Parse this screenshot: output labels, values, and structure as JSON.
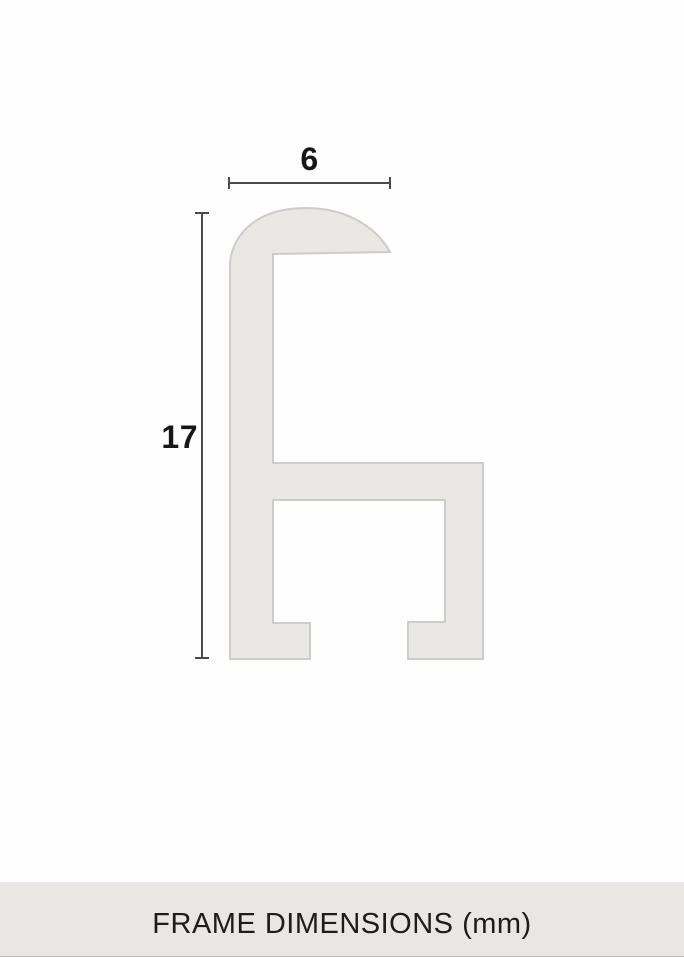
{
  "diagram": {
    "width_value": "6",
    "height_value": "17",
    "unit": "mm",
    "colors": {
      "profile_fill": "#e9e8e5",
      "profile_stroke": "#cdccc9",
      "dimension_line": "#4b4b4b",
      "label_text": "#171717"
    }
  },
  "footer": {
    "title": "FRAME DIMENSIONS (mm)",
    "background": "#e8e7e3",
    "text_color": "#1d1d1b"
  }
}
